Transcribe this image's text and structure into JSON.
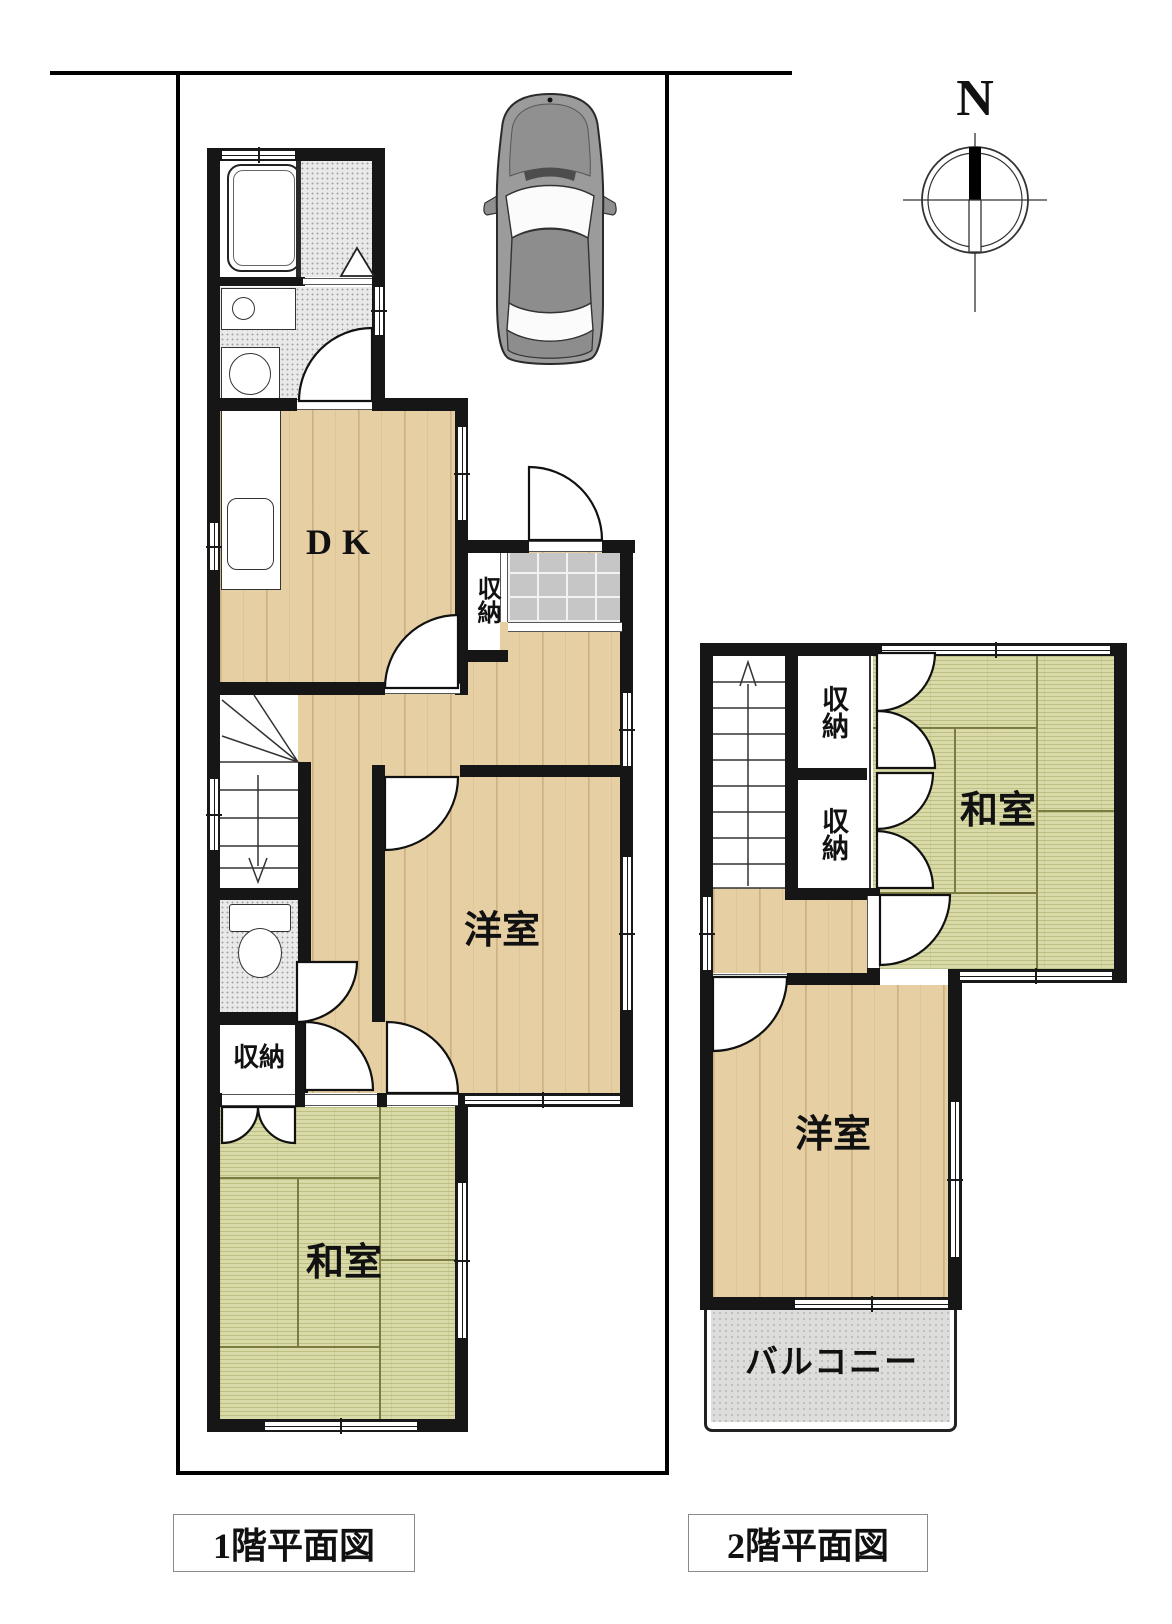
{
  "compass": {
    "label": "N"
  },
  "floor1": {
    "caption": "1階平面図",
    "labels": {
      "dk": "DK",
      "storage_entry": "収納",
      "storage_hall": "収納",
      "western_room": "洋室",
      "japanese_room": "和室"
    }
  },
  "floor2": {
    "caption": "2階平面図",
    "labels": {
      "storage_upper": "収納",
      "storage_lower": "収納",
      "japanese_room": "和室",
      "western_room": "洋室",
      "balcony": "バルコニー"
    }
  },
  "colors": {
    "wall": "#161616",
    "wood_floor": "#e6cfa3",
    "tatami": "#d9daa7",
    "tile": "#c6c6c6",
    "car_body": "#9b9b9b",
    "lot_line": "#000000"
  }
}
